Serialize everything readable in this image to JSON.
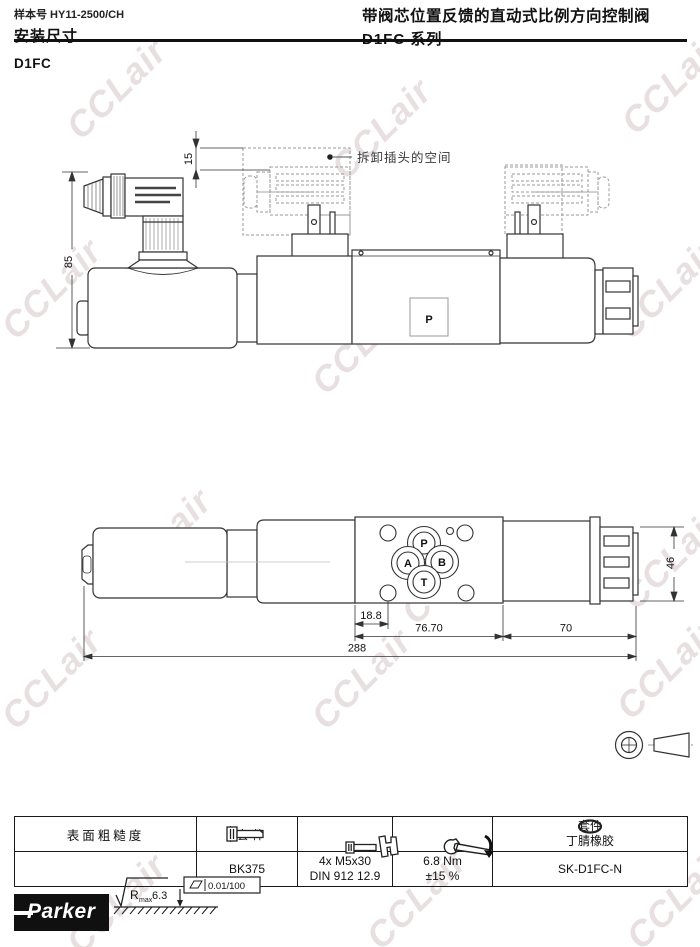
{
  "watermark": {
    "text": "CCLair"
  },
  "header": {
    "doc_number": "样本号 HY11-2500/CH",
    "page_title": "安装尺寸",
    "product_title": "带阀芯位置反馈的直动式比例方向控制阀",
    "series_title": "D1FC 系列",
    "section_label": "D1FC"
  },
  "drawing_side": {
    "callout": "拆卸插头的空间",
    "port_label": "P",
    "dims": {
      "height": "85",
      "plug_clearance": "15"
    }
  },
  "drawing_bottom": {
    "ports": {
      "p": "P",
      "a": "A",
      "b": "B",
      "t": "T"
    },
    "dims": {
      "hole_offset": "18.8",
      "block_width": "76.70",
      "right_len": "70",
      "overall": "288",
      "height": "46"
    }
  },
  "table": {
    "col1": {
      "header": "表面粗糙度",
      "rough_r": "R",
      "rough_sub": "max",
      "rough_val": "6.3",
      "flatness": "0.01/100"
    },
    "col2": {
      "header_label": "套 件",
      "value": "BK375"
    },
    "col3": {
      "value_line1": "4x M5x30",
      "value_line2": "DIN 912 12.9"
    },
    "col4": {
      "value_line1": "6.8 Nm",
      "value_line2": "±15 %"
    },
    "col5": {
      "header_label": "套件",
      "header_line2": "丁腈橡胶",
      "value": "SK-D1FC-N"
    }
  },
  "footer": {
    "logo_text": "Parker"
  }
}
